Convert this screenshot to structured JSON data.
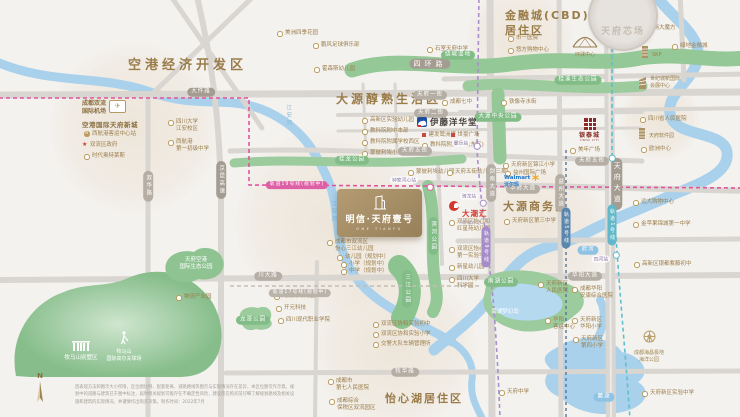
{
  "regions": [
    {
      "x": 128,
      "y": 57,
      "size": 13,
      "ls": 4,
      "lines": [
        "空港经济开发区"
      ]
    },
    {
      "x": 336,
      "y": 91,
      "size": 12,
      "ls": 3,
      "lines": [
        "大源醇熟生活区"
      ]
    },
    {
      "x": 505,
      "y": 9,
      "size": 11,
      "ls": 2,
      "lines": [
        "金融城(CBD)",
        "居住区"
      ]
    },
    {
      "x": 503,
      "y": 200,
      "size": 11,
      "ls": 2,
      "lines": [
        "大源商务区"
      ]
    },
    {
      "x": 385,
      "y": 392,
      "size": 11,
      "ls": 2,
      "lines": [
        "怡心湖居住区"
      ]
    }
  ],
  "pois": [
    {
      "x": 84,
      "y": 131,
      "icon": "metro",
      "lines": [
        "西航港客运中心站"
      ]
    },
    {
      "x": 82,
      "y": 142,
      "icon": "star",
      "lines": [
        "双流区政府"
      ]
    },
    {
      "x": 84,
      "y": 153,
      "icon": "ring",
      "lines": [
        "时代奥特莱斯"
      ]
    },
    {
      "x": 168,
      "y": 119,
      "icon": "ring",
      "lines": [
        "四川大学",
        "江安校区"
      ]
    },
    {
      "x": 168,
      "y": 139,
      "icon": "ring",
      "lines": [
        "西航港",
        "第一初级中学"
      ]
    },
    {
      "x": 277,
      "y": 30,
      "icon": "ring",
      "lines": [
        "美洲四季花园"
      ]
    },
    {
      "x": 313,
      "y": 42,
      "icon": "ring",
      "lines": [
        "鹏风足球俱乐部"
      ]
    },
    {
      "x": 314,
      "y": 66,
      "icon": "ring",
      "lines": [
        "霍森斯幼儿园"
      ]
    },
    {
      "x": 427,
      "y": 46,
      "icon": "ring",
      "lines": [
        "石室天府中学"
      ]
    },
    {
      "x": 508,
      "y": 35,
      "icon": "ring",
      "lines": [
        "市一医院"
      ]
    },
    {
      "x": 508,
      "y": 47,
      "icon": "ring",
      "lines": [
        "悠方购物中心"
      ]
    },
    {
      "x": 640,
      "y": 25,
      "icon": "ring",
      "lines": [
        "招商大魔方"
      ]
    },
    {
      "x": 672,
      "y": 43,
      "icon": "ring",
      "lines": [
        "绿地金融城"
      ]
    },
    {
      "x": 640,
      "y": 116,
      "icon": "ring",
      "lines": [
        "四川省人民医院"
      ]
    },
    {
      "x": 641,
      "y": 146,
      "icon": "ring",
      "lines": [
        "欧洲中心"
      ]
    },
    {
      "x": 570,
      "y": 147,
      "icon": "ring",
      "lines": [
        "美年广场"
      ]
    },
    {
      "x": 501,
      "y": 99,
      "icon": "ring",
      "lines": [
        "铁像寺水街"
      ]
    },
    {
      "x": 362,
      "y": 117,
      "icon": "ring",
      "lines": [
        "高新区实验幼儿园"
      ]
    },
    {
      "x": 362,
      "y": 128,
      "icon": "ring",
      "lines": [
        "教科院附中本部"
      ]
    },
    {
      "x": 362,
      "y": 139,
      "icon": "ring",
      "lines": [
        "教科院附属学校西区"
      ]
    },
    {
      "x": 362,
      "y": 150,
      "icon": "ring",
      "lines": [
        "蒙彼利埃小学"
      ]
    },
    {
      "x": 442,
      "y": 99,
      "icon": "ring",
      "lines": [
        "成都七中"
      ]
    },
    {
      "x": 422,
      "y": 132,
      "icon": "square",
      "lines": [
        "建发鹭洲里"
      ]
    },
    {
      "x": 451,
      "y": 132,
      "icon": "square",
      "lines": [
        "世豪广场"
      ]
    },
    {
      "x": 422,
      "y": 142,
      "icon": "ring",
      "lines": [
        "教科院附属学校(东区)"
      ]
    },
    {
      "x": 408,
      "y": 169,
      "icon": "ring",
      "lines": [
        "蒙彼利埃幼儿园"
      ]
    },
    {
      "x": 447,
      "y": 169,
      "icon": "ring",
      "lines": [
        "天府五街幼儿园(三期)"
      ]
    },
    {
      "x": 327,
      "y": 239,
      "icon": "ring",
      "lines": [
        "成都市双流区",
        "怡心三江幼儿园"
      ]
    },
    {
      "x": 337,
      "y": 254,
      "icon": "ring",
      "lines": [
        "幼儿园（规划中）"
      ]
    },
    {
      "x": 341,
      "y": 261,
      "icon": "ring",
      "lines": [
        "小学（规划中）"
      ]
    },
    {
      "x": 341,
      "y": 268,
      "icon": "ring",
      "lines": [
        "中学（规划中）"
      ]
    },
    {
      "x": 449,
      "y": 219,
      "icon": "ring",
      "lines": [
        "双流区怡心和",
        "红星苑幼儿园"
      ]
    },
    {
      "x": 449,
      "y": 246,
      "icon": "ring",
      "lines": [
        "双流区怡心",
        "第一实验学校"
      ]
    },
    {
      "x": 449,
      "y": 264,
      "icon": "ring",
      "lines": [
        "新星幼儿园"
      ]
    },
    {
      "x": 449,
      "y": 276,
      "icon": "ring",
      "lines": [
        "四川大学",
        "科学园"
      ]
    },
    {
      "x": 504,
      "y": 218,
      "icon": "ring",
      "lines": [
        "天府新区第三中学"
      ]
    },
    {
      "x": 503,
      "y": 162,
      "icon": "ring",
      "lines": [
        "天府新区锦江小学"
      ]
    },
    {
      "x": 505,
      "y": 170,
      "icon": "ring",
      "lines": [
        "益州国际广场"
      ]
    },
    {
      "x": 633,
      "y": 199,
      "icon": "ring",
      "lines": [
        "远大购物中心"
      ]
    },
    {
      "x": 633,
      "y": 221,
      "icon": "ring",
      "lines": [
        "金苹果锦城第一中学"
      ]
    },
    {
      "x": 634,
      "y": 261,
      "icon": "ring",
      "lines": [
        "高新区银都紫藤初中"
      ]
    },
    {
      "x": 328,
      "y": 378,
      "icon": "ring",
      "lines": [
        "成都市",
        "第七人民医院"
      ]
    },
    {
      "x": 329,
      "y": 398,
      "icon": "ring",
      "lines": [
        "成都综合",
        "保税区双流园区"
      ]
    },
    {
      "x": 373,
      "y": 321,
      "icon": "ring",
      "lines": [
        "双流区协和实验初中"
      ]
    },
    {
      "x": 373,
      "y": 331,
      "icon": "ring",
      "lines": [
        "双流区协和实验小学"
      ]
    },
    {
      "x": 373,
      "y": 341,
      "icon": "ring",
      "lines": [
        "交警大队车辆管理所"
      ]
    },
    {
      "x": 274,
      "y": 293,
      "icon": "ring",
      "lines": [
        "九龙湖幼儿园"
      ]
    },
    {
      "x": 276,
      "y": 305,
      "icon": "ring",
      "lines": [
        "开元科技"
      ]
    },
    {
      "x": 278,
      "y": 317,
      "icon": "ring",
      "lines": [
        "四川现代职业学院"
      ]
    },
    {
      "x": 538,
      "y": 281,
      "icon": "ring",
      "lines": [
        "天府新区",
        "人民医院"
      ]
    },
    {
      "x": 545,
      "y": 317,
      "icon": "ring",
      "lines": [
        "华阳",
        "客运中心"
      ]
    },
    {
      "x": 572,
      "y": 286,
      "icon": "ring",
      "lines": [
        "成都华阳",
        "安康综合医院"
      ]
    },
    {
      "x": 572,
      "y": 317,
      "icon": "ring",
      "lines": [
        "天府新区",
        "华阳小学"
      ]
    },
    {
      "x": 573,
      "y": 336,
      "icon": "ring",
      "lines": [
        "天府新区",
        "第四小学"
      ]
    },
    {
      "x": 642,
      "y": 390,
      "icon": "ring",
      "lines": [
        "天府新区实验中学"
      ]
    },
    {
      "x": 499,
      "y": 389,
      "icon": "ring",
      "lines": [
        "天府中学"
      ]
    },
    {
      "x": 176,
      "y": 294,
      "icon": "ring",
      "lines": [
        "物流产业园"
      ]
    },
    {
      "x": 196,
      "y": 257,
      "icon": "none",
      "white": 1,
      "c": 1,
      "lines": [
        "天府空港",
        "国际生态公园"
      ]
    },
    {
      "x": 505,
      "y": 309,
      "icon": "none",
      "white": 1,
      "c": 1,
      "lines": [
        "南湖梦幻岛"
      ]
    }
  ],
  "pills": [
    {
      "x": 201,
      "y": 92,
      "text": "大件路",
      "s": "dark"
    },
    {
      "x": 430,
      "y": 64,
      "text": "四环路",
      "s": "dark",
      "big": 1
    },
    {
      "x": 458,
      "y": 55,
      "text": "绕城湿地",
      "s": "green"
    },
    {
      "x": 221,
      "y": 180,
      "text": "京昆高速",
      "s": "dark",
      "v": 1
    },
    {
      "x": 148,
      "y": 186,
      "text": "双华路",
      "s": "gray",
      "v": 1
    },
    {
      "x": 430,
      "y": 95,
      "text": "天府一街",
      "s": "gray"
    },
    {
      "x": 431,
      "y": 113,
      "text": "天府二街",
      "s": "gray"
    },
    {
      "x": 415,
      "y": 151,
      "text": "天府五街",
      "s": "gray"
    },
    {
      "x": 592,
      "y": 161,
      "text": "天府五街",
      "s": "gray"
    },
    {
      "x": 523,
      "y": 189,
      "text": "华府大道",
      "s": "gray"
    },
    {
      "x": 585,
      "y": 276,
      "text": "华阳大道",
      "s": "gray"
    },
    {
      "x": 268,
      "y": 276,
      "text": "川大路",
      "s": "gray"
    },
    {
      "x": 405,
      "y": 372,
      "text": "牧华路",
      "s": "gray"
    },
    {
      "x": 491,
      "y": 183,
      "text": "剑南大道",
      "s": "gray",
      "v": 1
    },
    {
      "x": 560,
      "y": 193,
      "text": "益州大道",
      "s": "gray",
      "v": 1
    },
    {
      "x": 617,
      "y": 184,
      "text": "天府大道",
      "s": "dark",
      "v": 1,
      "big": 1
    },
    {
      "x": 578,
      "y": 80,
      "text": "桂溪生态公园",
      "s": "green"
    },
    {
      "x": 498,
      "y": 117,
      "text": "大源中央公园",
      "s": "green"
    },
    {
      "x": 352,
      "y": 160,
      "text": "桂龙公园",
      "s": "green"
    },
    {
      "x": 407,
      "y": 289,
      "text": "三江公园",
      "s": "green",
      "v": 1
    },
    {
      "x": 433,
      "y": 236,
      "text": "滨河公园",
      "s": "green",
      "v": 1
    },
    {
      "x": 501,
      "y": 282,
      "text": "南湖公园",
      "s": "green"
    },
    {
      "x": 253,
      "y": 320,
      "text": "龙潭公园",
      "s": "green"
    },
    {
      "x": 588,
      "y": 250,
      "text": "府河",
      "s": "blue"
    },
    {
      "x": 604,
      "y": 397,
      "text": "麓湖",
      "s": "blue"
    },
    {
      "x": 288,
      "y": 116,
      "text": "江安河",
      "s": "bluetext",
      "v": 1
    },
    {
      "x": 333,
      "y": 212,
      "text": "江安河",
      "s": "bluetext",
      "v": 1
    },
    {
      "x": 297,
      "y": 185,
      "text": "轨道19号线(规划中)",
      "s": "magenta"
    },
    {
      "x": 486,
      "y": 247,
      "text": "轨道9号线",
      "s": "purple",
      "v": 1
    },
    {
      "x": 612,
      "y": 225,
      "text": "轨道1号线",
      "s": "teal",
      "v": 1
    },
    {
      "x": 566,
      "y": 228,
      "text": "轨道5号线",
      "s": "navy",
      "v": 1
    },
    {
      "x": 300,
      "y": 293,
      "text": "轨道17号线(规划中)",
      "s": "graydash"
    }
  ],
  "stations": [
    {
      "cx": 430,
      "cy": 187,
      "cls": "m",
      "label": "钟家河心站",
      "lx": 404,
      "ly": 180
    },
    {
      "cx": 477,
      "cy": 146,
      "cls": "",
      "label": "麓乐站",
      "lx": 461,
      "ly": 143
    },
    {
      "cx": 483,
      "cy": 203,
      "cls": "",
      "label": "骑龙站",
      "lx": 469,
      "ly": 196
    },
    {
      "cx": 616,
      "cy": 255,
      "cls": "t",
      "label": "四河站",
      "lx": 601,
      "ly": 259
    },
    {
      "cx": 612,
      "cy": 158,
      "cls": "t",
      "label": "",
      "lx": 0,
      "ly": 0
    }
  ],
  "landmarks": {
    "airport": {
      "lines": [
        "成都双流",
        "国际机场"
      ],
      "city": "空港国际天府新城"
    },
    "ito": {
      "label": "伊藤洋华堂"
    },
    "dachaohui": {
      "label": "大潮汇",
      "sub": "购物中心"
    },
    "yintai": {
      "label": "银泰城",
      "en": "YINTAI CITY"
    },
    "walmart": {
      "en": "Walmart",
      "cn": "沃尔玛"
    },
    "globe": {
      "label": "环球中心"
    },
    "skp": {
      "label": "SKP"
    },
    "expo": {
      "lines": [
        "世纪城新国际",
        "会展中心"
      ]
    },
    "software": {
      "label": "天府软件园"
    },
    "villa": {
      "label": "牧马山别墅区"
    },
    "golf": {
      "lines": [
        "牧马山",
        "国际高尔夫球场"
      ]
    },
    "haichang": {
      "lines": [
        "成都海昌极地",
        "海洋公园"
      ]
    }
  },
  "property": {
    "name": "明信·天府壹号",
    "en": "ONE TIANFU"
  },
  "stamp": {
    "text": "天府芯场"
  },
  "compass": {
    "label": "N"
  },
  "disclaimer": [
    "因表现方法和图示大小所限，区位图比例、配套距离、道路路线等图示与实际情况存在差异，本区位图仅作示意。规",
    "划中的道路与建筑已于图中标注，届时相关规划可能存在不确定性风险，建议您在购买前仔细了解规划路线及相关设",
    "施和建筑的实际情况，并谨慎作出购买决策。制作时间：2022年7月"
  ]
}
